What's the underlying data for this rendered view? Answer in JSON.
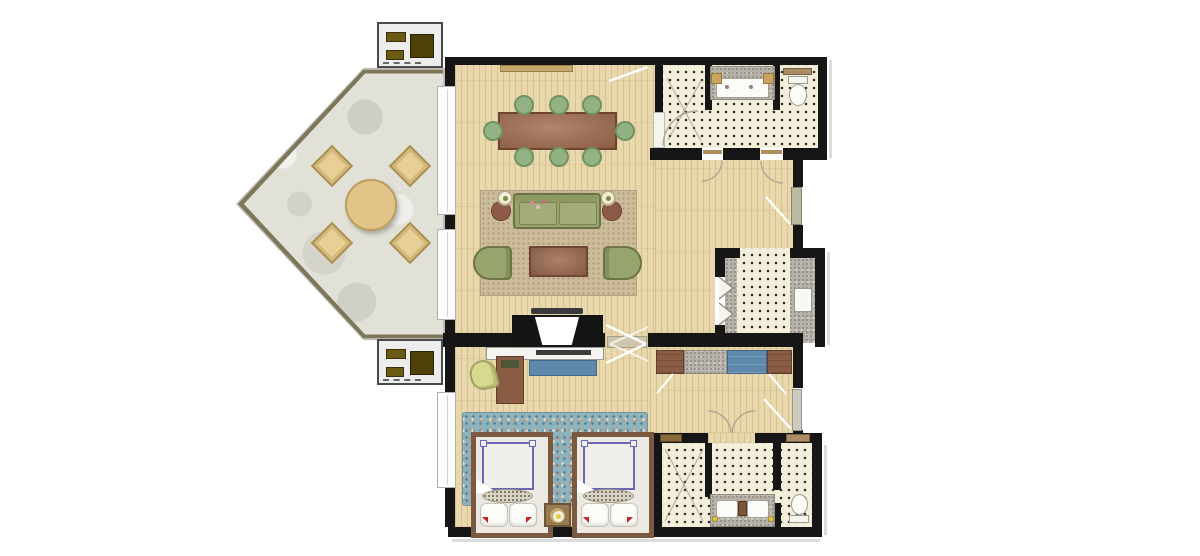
{
  "meta": {
    "description": "Architectural floor plan of a hotel suite: pentagonal stone terrace with outdoor seating, wood-floored living and dining room, bedroom with two twin beds, two mosaic-tiled bathrooms and an entry foyer",
    "visible_text": []
  },
  "rooms": {
    "terrace": {
      "label": "Pentagonal terrace",
      "floor": "stone",
      "furniture": {
        "outdoor_armchairs": 4,
        "round_table": 1
      }
    },
    "living": {
      "label": "Living and dining room",
      "floor": "wood plank",
      "furniture": {
        "dining_table": 1,
        "dining_chairs": 8,
        "sofa": 1,
        "lounge_armchairs": 2,
        "coffee_table": 1,
        "side_tables": 2,
        "table_lamps": 2,
        "area_rug": 1,
        "fireplace_tv_unit": 1,
        "wall_console": 1
      }
    },
    "bathroom_top": {
      "label": "Guest bathroom with shower, vanity and WC",
      "floor": "mosaic tile",
      "fixtures": {
        "shower": 1,
        "vanity_basin": 1,
        "toilet": 1,
        "shelf": 1
      }
    },
    "foyer": {
      "label": "Entry foyer with bifold closet and counter",
      "floor": "mosaic tile",
      "fixtures": {
        "bifold_closet": 1,
        "stone_counter": 1,
        "cabinet_fixture": 1
      }
    },
    "bedroom": {
      "label": "Bedroom with two twin beds",
      "floor": "wood plank",
      "furniture": {
        "twin_beds": 2,
        "pillows": 4,
        "nightstand": 1,
        "round_lamp": 1,
        "tv_dresser": 1,
        "blue_bench": 1,
        "desk": 1,
        "desk_chair": 1,
        "wardrobe_sections": 4,
        "area_rug": 1
      }
    },
    "bathroom_bottom": {
      "label": "Main bathroom with shower, double vanity and WC",
      "floor": "mosaic tile",
      "fixtures": {
        "shower": 1,
        "vanity_basins": 2,
        "toilet": 1,
        "sconce_lamps": 2
      }
    }
  },
  "exterior": {
    "ac_units": 2,
    "entry_door": 1,
    "connecting_door": 1
  },
  "palette": {
    "wall": "#161616",
    "wood_floor": "#e9d8ac",
    "mosaic_tile": "#f4efdb",
    "terrace_stone": "#e1e1d8",
    "terrace_border": "#7e7659",
    "outdoor_tan": "#e7cf96",
    "dining_table_brown": "#a06b4e",
    "chair_green": "#92b286",
    "sofa_olive": "#98a46e",
    "rug_beige": "#cdbc9a",
    "bedroom_rug_blue": "#8fb2bb",
    "accent_blue": "#5e88ac",
    "bed_frame_brown": "#7b5a41",
    "marble_gray": "#b6b2a9",
    "lamp_yellow": "#e6c83e",
    "door_leaf": "#b9bba3"
  }
}
